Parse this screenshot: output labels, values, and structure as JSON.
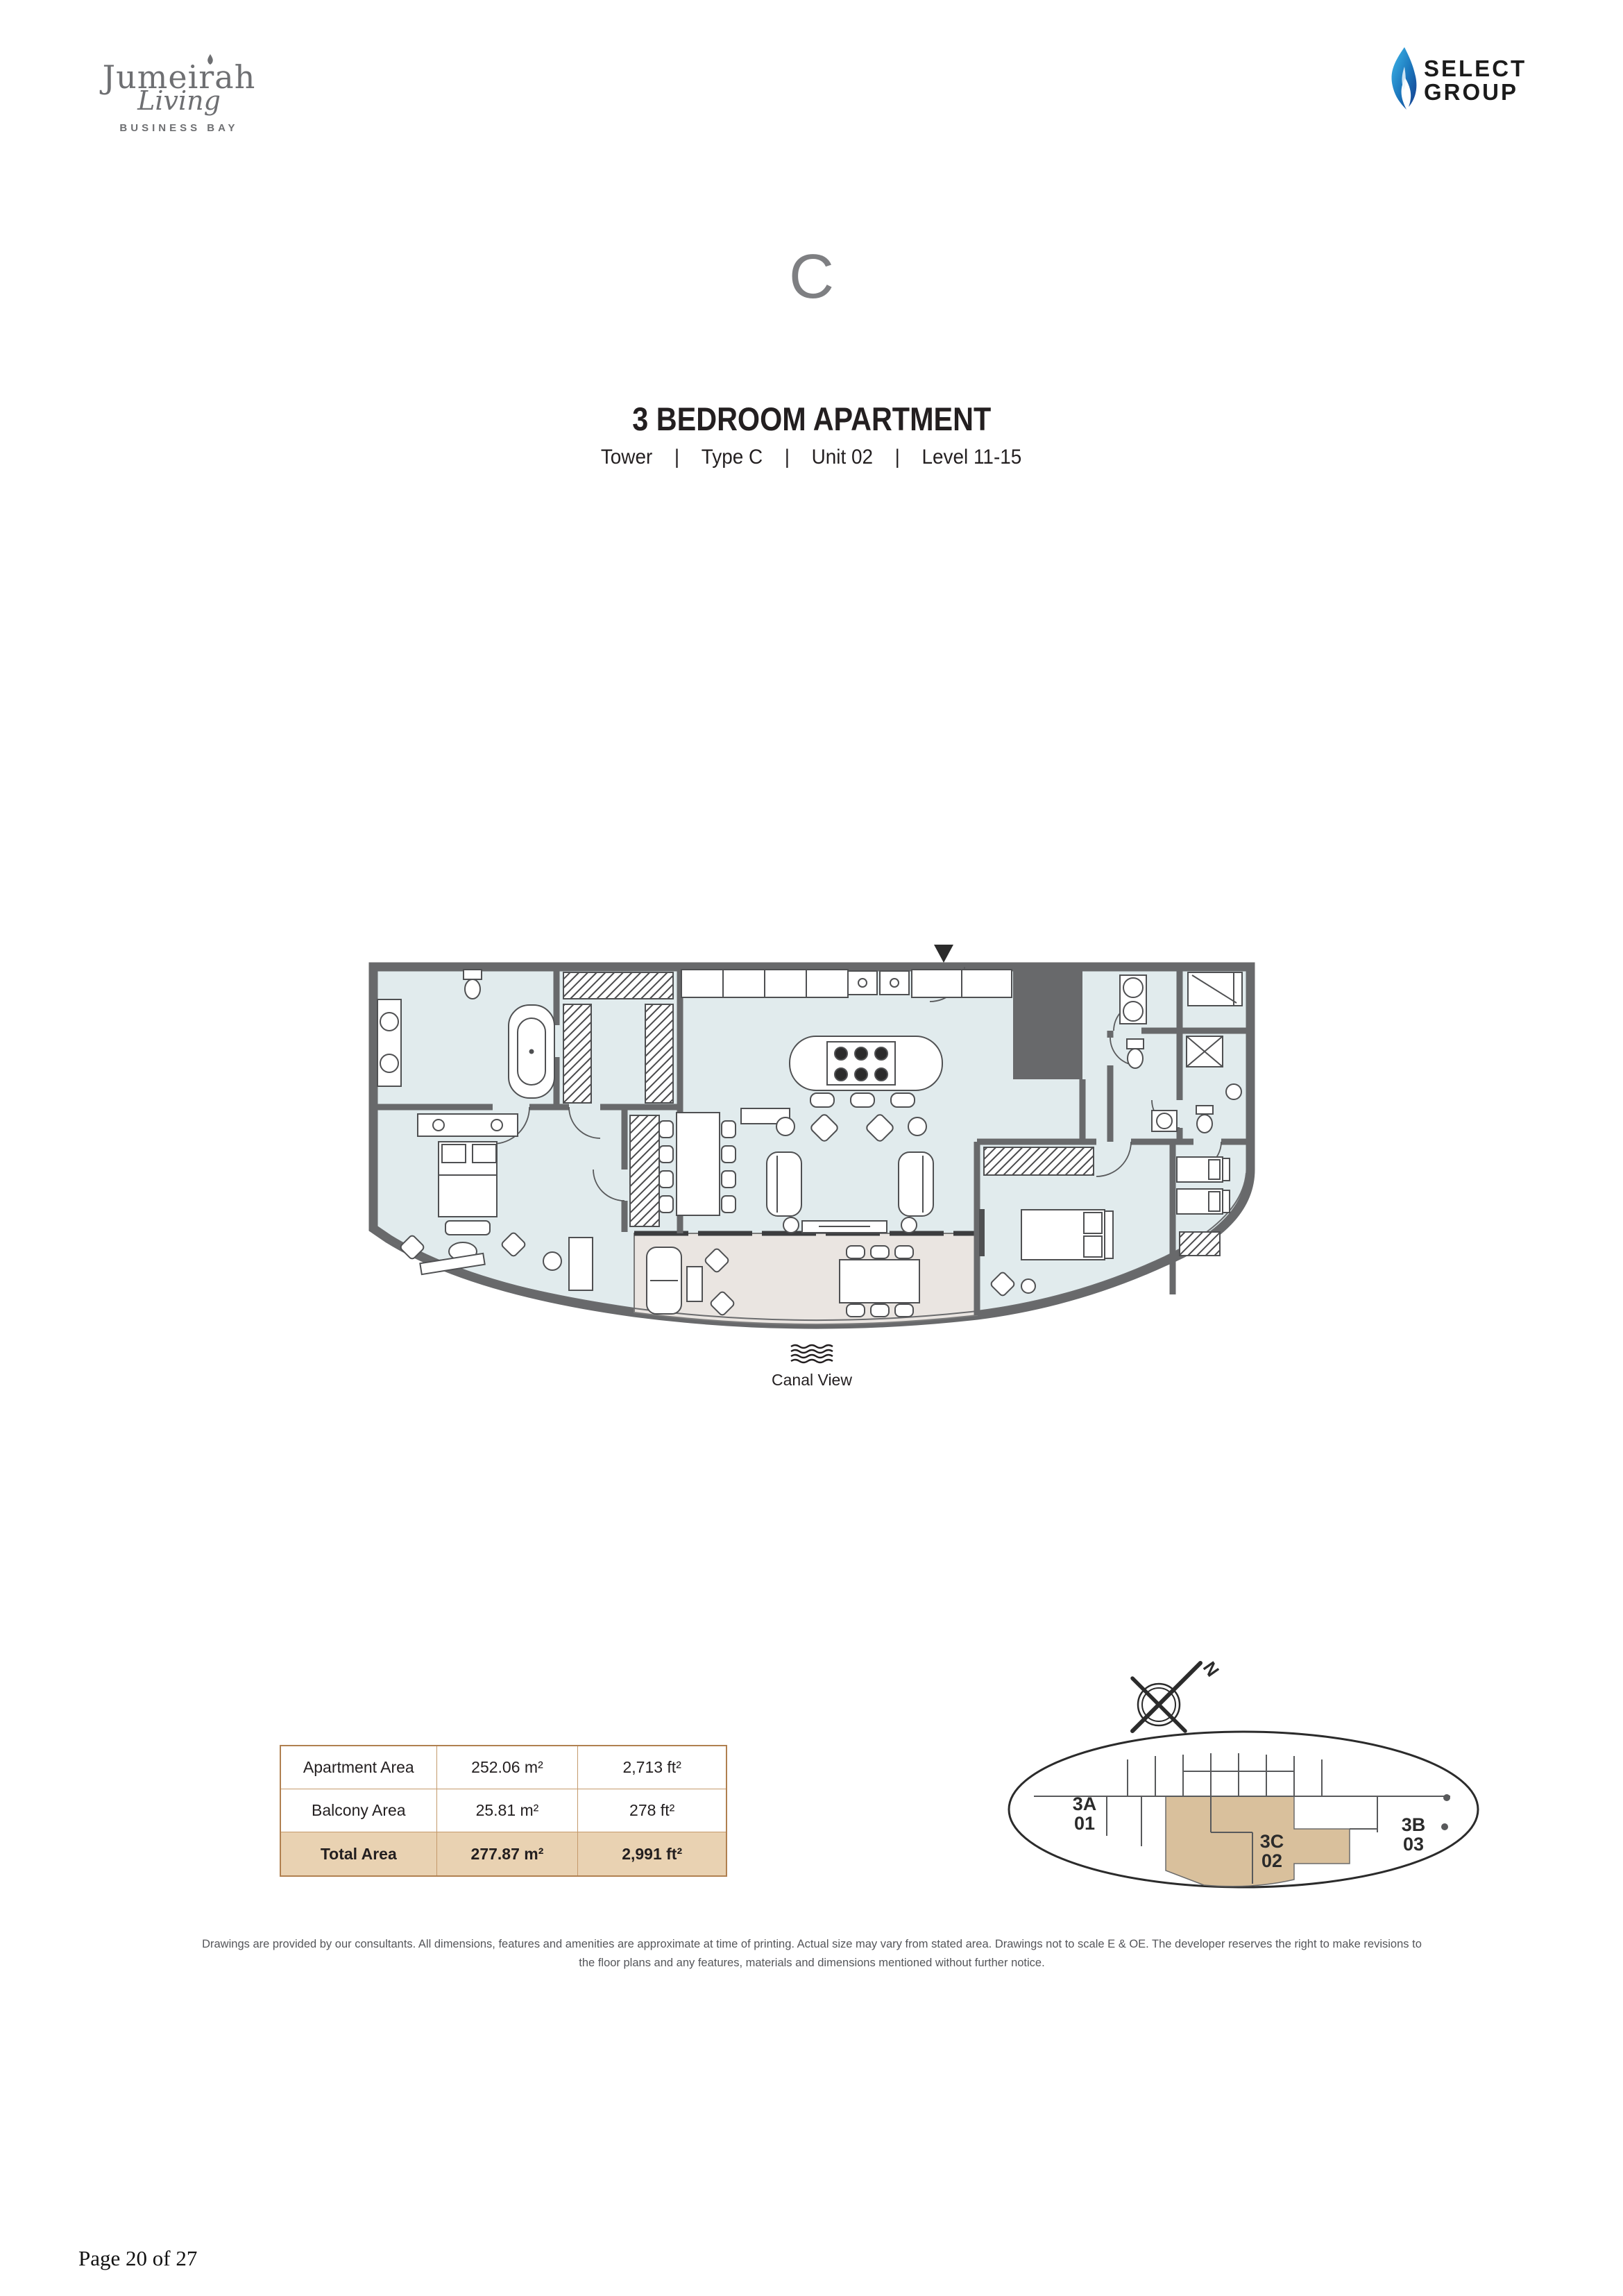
{
  "brand": {
    "name": "Jumeirah",
    "script": "Living",
    "location": "BUSINESS BAY"
  },
  "developer": {
    "name_line1": "SELECT",
    "name_line2": "GROUP",
    "flame_color_top": "#3fb9eb",
    "flame_color_bottom": "#143a8c"
  },
  "unit": {
    "letter": "C",
    "title": "3 BEDROOM APARTMENT",
    "separator": "|",
    "meta": [
      "Tower",
      "Type C",
      "Unit 02",
      "Level 11-15"
    ]
  },
  "plan": {
    "view_label": "Canal View"
  },
  "area_table": {
    "rows": [
      {
        "label": "Apartment Area",
        "m2": "252.06 m²",
        "ft2": "2,713 ft²"
      },
      {
        "label": "Balcony Area",
        "m2": "25.81 m²",
        "ft2": "278 ft²"
      },
      {
        "label": "Total Area",
        "m2": "277.87 m²",
        "ft2": "2,991 ft²"
      }
    ]
  },
  "key_plan": {
    "compass_label": "N",
    "unit_a_line1": "3A",
    "unit_a_line2": "01",
    "unit_b_line1": "3B",
    "unit_b_line2": "03",
    "unit_c_line1": "3C",
    "unit_c_line2": "02",
    "highlight_color": "#d9c09c"
  },
  "disclaimer": "Drawings are provided by our consultants. All dimensions, features and amenities are approximate at time of printing.  Actual size may vary from stated area. Drawings not to scale E & OE. The developer reserves the right to make revisions to the floor plans and any features, materials and dimensions mentioned without further notice.",
  "footer": {
    "page_label": "Page 20 of 27"
  },
  "colors": {
    "wall": "#68696b",
    "room_fill": "#e1ebed",
    "balcony_fill": "#eae5e1",
    "table_border": "#b08050",
    "total_row_bg": "#e9d2b2",
    "logo_gray": "#6e6f72"
  }
}
